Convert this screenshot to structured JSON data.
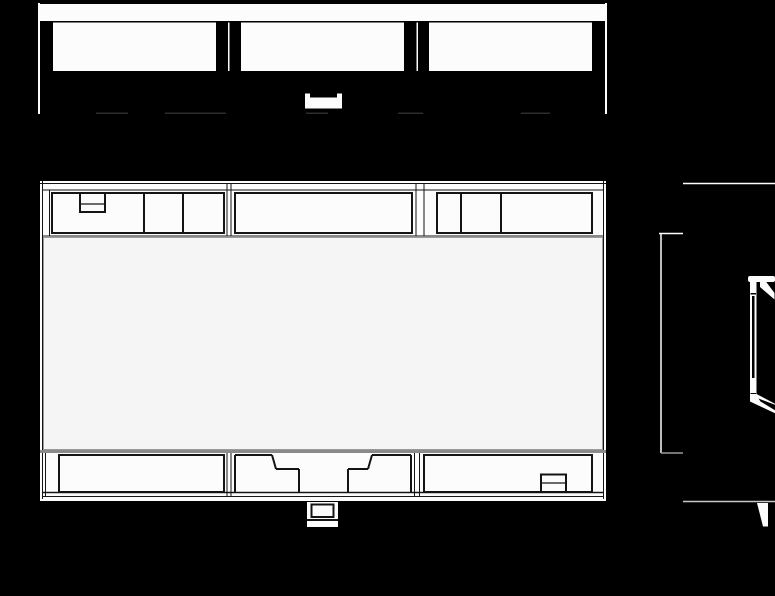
{
  "canvas": {
    "width": 775,
    "height": 596,
    "background": "#000000"
  },
  "palette": {
    "white": "#fcfcfc",
    "ink": "#141414",
    "face": "#f5f5f5",
    "gray": "#8a8a8a",
    "light": "#c8c8c8",
    "faint": "#3c3c3c",
    "black": "#000000"
  },
  "drawing_title": "din-rail-module-orthographic-views",
  "views": [
    {
      "id": "top-view",
      "shapes": [
        {
          "name": "outline-left",
          "type": "rect",
          "x": 38,
          "y": 3,
          "w": 2,
          "h": 111,
          "fill": "white"
        },
        {
          "name": "outline-right",
          "type": "rect",
          "x": 605,
          "y": 3,
          "w": 2,
          "h": 111,
          "fill": "white"
        },
        {
          "name": "front-rim",
          "type": "rect",
          "x": 40,
          "y": 4,
          "w": 566,
          "h": 17,
          "fill": "white"
        },
        {
          "name": "terminal-window-1",
          "type": "rect",
          "x": 53,
          "y": 22.5,
          "w": 163,
          "h": 48.5,
          "fill": "white"
        },
        {
          "name": "terminal-window-2",
          "type": "rect",
          "x": 241,
          "y": 22.5,
          "w": 163,
          "h": 48.5,
          "fill": "white"
        },
        {
          "name": "terminal-window-3",
          "type": "rect",
          "x": 429,
          "y": 22.5,
          "w": 163,
          "h": 48.5,
          "fill": "white"
        },
        {
          "name": "module-joint-line-1",
          "type": "rect",
          "x": 228,
          "y": 22.5,
          "w": 1.5,
          "h": 48.5,
          "fill": "white"
        },
        {
          "name": "module-joint-line-2",
          "type": "rect",
          "x": 416.5,
          "y": 22.5,
          "w": 1.5,
          "h": 48.5,
          "fill": "white"
        },
        {
          "name": "bus-connector",
          "type": "rect",
          "x": 305,
          "y": 97.5,
          "w": 37,
          "h": 11,
          "fill": "white"
        },
        {
          "name": "bus-connector-ear-left",
          "type": "rect",
          "x": 305,
          "y": 93.5,
          "w": 5,
          "h": 5,
          "fill": "white"
        },
        {
          "name": "bus-connector-ear-right",
          "type": "rect",
          "x": 337,
          "y": 93.5,
          "w": 5,
          "h": 5,
          "fill": "white"
        },
        {
          "name": "hidden-edge-dash-1",
          "type": "line",
          "x1": 96,
          "y1": 113.2,
          "x2": 128,
          "y2": 113.2,
          "stroke": "faint",
          "sw": 1.2
        },
        {
          "name": "hidden-edge-dash-2",
          "type": "line",
          "x1": 165,
          "y1": 113.2,
          "x2": 226,
          "y2": 113.2,
          "stroke": "faint",
          "sw": 1.2
        },
        {
          "name": "hidden-edge-dash-3",
          "type": "line",
          "x1": 306,
          "y1": 113.2,
          "x2": 328,
          "y2": 113.2,
          "stroke": "faint",
          "sw": 1.2
        },
        {
          "name": "hidden-edge-dash-4",
          "type": "line",
          "x1": 398,
          "y1": 113.2,
          "x2": 423,
          "y2": 113.2,
          "stroke": "faint",
          "sw": 1.2
        },
        {
          "name": "hidden-edge-dash-5",
          "type": "line",
          "x1": 521,
          "y1": 113.2,
          "x2": 550,
          "y2": 113.2,
          "stroke": "faint",
          "sw": 1.2
        }
      ]
    },
    {
      "id": "front-view",
      "shapes": [
        {
          "name": "body",
          "type": "rect",
          "x": 40,
          "y": 181,
          "w": 566,
          "h": 320,
          "fill": "white"
        },
        {
          "name": "edge-top",
          "type": "line",
          "x1": 40,
          "y1": 183.5,
          "x2": 606,
          "y2": 183.5,
          "stroke": "ink",
          "sw": 1
        },
        {
          "name": "edge-left",
          "type": "line",
          "x1": 42.5,
          "y1": 181,
          "x2": 42.5,
          "y2": 499,
          "stroke": "ink",
          "sw": 1
        },
        {
          "name": "edge-right",
          "type": "line",
          "x1": 603.5,
          "y1": 181,
          "x2": 603.5,
          "y2": 499,
          "stroke": "ink",
          "sw": 1
        },
        {
          "name": "ledge-top",
          "type": "line",
          "x1": 43,
          "y1": 190,
          "x2": 603,
          "y2": 190,
          "stroke": "ink",
          "sw": 1
        },
        {
          "name": "edge-bottom",
          "type": "line",
          "x1": 43,
          "y1": 496.5,
          "x2": 603,
          "y2": 496.5,
          "stroke": "ink",
          "sw": 1
        },
        {
          "name": "margin-line-top-left",
          "type": "line",
          "x1": 49.5,
          "y1": 190,
          "x2": 49.5,
          "y2": 236,
          "stroke": "ink",
          "sw": 1
        },
        {
          "name": "margin-line-bottom-left",
          "type": "line",
          "x1": 45.5,
          "y1": 453,
          "x2": 45.5,
          "y2": 496,
          "stroke": "ink",
          "sw": 1
        },
        {
          "name": "top-terminal-block-1",
          "type": "rect",
          "x": 52,
          "y": 193,
          "w": 172,
          "h": 40,
          "stroke": "ink",
          "sw": 2
        },
        {
          "name": "top-terminal-block-2",
          "type": "rect",
          "x": 235,
          "y": 193,
          "w": 177,
          "h": 40,
          "stroke": "ink",
          "sw": 2
        },
        {
          "name": "top-terminal-block-3",
          "type": "rect",
          "x": 437,
          "y": 193,
          "w": 155,
          "h": 40,
          "stroke": "ink",
          "sw": 2
        },
        {
          "name": "top-divider-1",
          "type": "line",
          "x1": 144,
          "y1": 193,
          "x2": 144,
          "y2": 233,
          "stroke": "ink",
          "sw": 2
        },
        {
          "name": "top-divider-2",
          "type": "line",
          "x1": 183,
          "y1": 193,
          "x2": 183,
          "y2": 233,
          "stroke": "ink",
          "sw": 2
        },
        {
          "name": "top-divider-3",
          "type": "line",
          "x1": 461,
          "y1": 193,
          "x2": 461,
          "y2": 233,
          "stroke": "ink",
          "sw": 2
        },
        {
          "name": "top-divider-4",
          "type": "line",
          "x1": 501,
          "y1": 193,
          "x2": 501,
          "y2": 233,
          "stroke": "ink",
          "sw": 2
        },
        {
          "name": "top-terminal-notch",
          "type": "rect",
          "x": 80,
          "y": 193,
          "w": 25,
          "h": 19,
          "stroke": "ink",
          "sw": 2
        },
        {
          "name": "top-terminal-notch-line",
          "type": "line",
          "x1": 80,
          "y1": 204,
          "x2": 105,
          "y2": 204,
          "stroke": "ink",
          "sw": 1.2
        },
        {
          "name": "joint-top-left-a",
          "type": "line",
          "x1": 227,
          "y1": 184,
          "x2": 227,
          "y2": 236,
          "stroke": "ink",
          "sw": 1
        },
        {
          "name": "joint-top-left-b",
          "type": "line",
          "x1": 231,
          "y1": 184,
          "x2": 231,
          "y2": 236,
          "stroke": "ink",
          "sw": 1
        },
        {
          "name": "joint-top-right-a",
          "type": "line",
          "x1": 416,
          "y1": 184,
          "x2": 416,
          "y2": 236,
          "stroke": "ink",
          "sw": 1
        },
        {
          "name": "joint-top-right-b",
          "type": "line",
          "x1": 424,
          "y1": 184,
          "x2": 424,
          "y2": 236,
          "stroke": "ink",
          "sw": 1
        },
        {
          "name": "joint-bottom-left-a",
          "type": "line",
          "x1": 227,
          "y1": 451,
          "x2": 227,
          "y2": 496,
          "stroke": "ink",
          "sw": 1
        },
        {
          "name": "joint-bottom-left-b",
          "type": "line",
          "x1": 231,
          "y1": 451,
          "x2": 231,
          "y2": 496,
          "stroke": "ink",
          "sw": 1
        },
        {
          "name": "joint-bottom-right-a",
          "type": "line",
          "x1": 414.5,
          "y1": 451,
          "x2": 414.5,
          "y2": 496,
          "stroke": "ink",
          "sw": 1
        },
        {
          "name": "joint-bottom-right-b",
          "type": "line",
          "x1": 419.5,
          "y1": 451,
          "x2": 419.5,
          "y2": 496,
          "stroke": "ink",
          "sw": 1
        },
        {
          "name": "front-plate",
          "type": "rect",
          "x": 43.5,
          "y": 237.5,
          "w": 559,
          "h": 212,
          "fill": "face",
          "stroke": "#9a9a9a",
          "sw": 1
        },
        {
          "name": "front-plate-top-line",
          "type": "line",
          "x1": 43,
          "y1": 236,
          "x2": 603,
          "y2": 236,
          "stroke": "ink",
          "sw": 1
        },
        {
          "name": "din-rail-shadow-bar",
          "type": "rect",
          "x": 40,
          "y": 450,
          "w": 566,
          "h": 3,
          "fill": "gray"
        },
        {
          "name": "bottom-terminal-block-1",
          "type": "rect",
          "x": 59,
          "y": 455,
          "w": 165,
          "h": 37,
          "stroke": "ink",
          "sw": 2
        },
        {
          "name": "bottom-terminal-block-3",
          "type": "rect",
          "x": 424,
          "y": 455,
          "w": 168,
          "h": 37,
          "stroke": "ink",
          "sw": 2
        },
        {
          "name": "block2-top-left",
          "type": "line",
          "x1": 235,
          "y1": 455,
          "x2": 272,
          "y2": 455,
          "stroke": "ink",
          "sw": 2
        },
        {
          "name": "block2-top-right",
          "type": "line",
          "x1": 372,
          "y1": 455,
          "x2": 411,
          "y2": 455,
          "stroke": "ink",
          "sw": 2
        },
        {
          "name": "block2-left",
          "type": "line",
          "x1": 235,
          "y1": 455,
          "x2": 235,
          "y2": 492,
          "stroke": "ink",
          "sw": 2
        },
        {
          "name": "block2-right",
          "type": "line",
          "x1": 411,
          "y1": 455,
          "x2": 411,
          "y2": 492,
          "stroke": "ink",
          "sw": 2
        },
        {
          "name": "clip-cutout-diag-left",
          "type": "line",
          "x1": 272,
          "y1": 455,
          "x2": 276,
          "y2": 469,
          "stroke": "ink",
          "sw": 2
        },
        {
          "name": "clip-cutout-diag-right",
          "type": "line",
          "x1": 372,
          "y1": 455,
          "x2": 368,
          "y2": 469,
          "stroke": "ink",
          "sw": 2
        },
        {
          "name": "clip-cutout-shelf-left",
          "type": "line",
          "x1": 276,
          "y1": 469,
          "x2": 299,
          "y2": 469,
          "stroke": "ink",
          "sw": 2
        },
        {
          "name": "clip-cutout-shelf-right",
          "type": "line",
          "x1": 348,
          "y1": 469,
          "x2": 368,
          "y2": 469,
          "stroke": "ink",
          "sw": 2
        },
        {
          "name": "clip-cutout-side-left",
          "type": "line",
          "x1": 299,
          "y1": 469,
          "x2": 299,
          "y2": 492,
          "stroke": "ink",
          "sw": 2
        },
        {
          "name": "clip-cutout-side-right",
          "type": "line",
          "x1": 348,
          "y1": 469,
          "x2": 348,
          "y2": 492,
          "stroke": "ink",
          "sw": 2
        },
        {
          "name": "bottom-edge-line",
          "type": "line",
          "x1": 43,
          "y1": 492.5,
          "x2": 603,
          "y2": 492.5,
          "stroke": "ink",
          "sw": 1.5
        },
        {
          "name": "bottom-terminal-box",
          "type": "rect",
          "x": 541,
          "y": 474.5,
          "w": 25,
          "h": 17.5,
          "stroke": "ink",
          "sw": 2
        },
        {
          "name": "bottom-terminal-box-line",
          "type": "line",
          "x1": 541,
          "y1": 483,
          "x2": 566,
          "y2": 483,
          "stroke": "ink",
          "sw": 1.2
        },
        {
          "name": "rail-clip-tab",
          "type": "rect",
          "x": 307,
          "y": 502,
          "w": 31,
          "h": 25,
          "fill": "white"
        },
        {
          "name": "rail-clip-tab-inner",
          "type": "rect",
          "x": 311.5,
          "y": 504.5,
          "w": 22,
          "h": 12.5,
          "stroke": "ink",
          "sw": 2
        },
        {
          "name": "rail-clip-tab-line",
          "type": "line",
          "x1": 307,
          "y1": 520,
          "x2": 338,
          "y2": 520,
          "stroke": "ink",
          "sw": 2
        }
      ]
    },
    {
      "id": "side-view",
      "shapes": [
        {
          "name": "top-edge",
          "type": "line",
          "x1": 683,
          "y1": 183.5,
          "x2": 775,
          "y2": 183.5,
          "stroke": "white",
          "sw": 1.5
        },
        {
          "name": "top-step",
          "type": "line",
          "x1": 659,
          "y1": 233.5,
          "x2": 683,
          "y2": 233.5,
          "stroke": "white",
          "sw": 1.5
        },
        {
          "name": "front-face-edge",
          "type": "line",
          "x1": 661,
          "y1": 233.5,
          "x2": 661,
          "y2": 453,
          "stroke": "white",
          "sw": 1.5
        },
        {
          "name": "bottom-step",
          "type": "line",
          "x1": 661,
          "y1": 453,
          "x2": 683,
          "y2": 453,
          "stroke": "#9a9a9a",
          "sw": 1.5
        },
        {
          "name": "bottom-edge",
          "type": "line",
          "x1": 683,
          "y1": 501.5,
          "x2": 775,
          "y2": 501.5,
          "stroke": "light",
          "sw": 1.5
        },
        {
          "name": "rail-clip-hook",
          "type": "polygon",
          "points": [
            [
              757,
              503
            ],
            [
              768,
              503
            ],
            [
              768,
              526.5
            ],
            [
              763,
              526.5
            ]
          ],
          "fill": "white"
        },
        {
          "name": "din-rail-top-flange",
          "type": "rect",
          "x": 748,
          "y": 276,
          "w": 27,
          "h": 6,
          "rx": 2,
          "fill": "white"
        },
        {
          "name": "din-rail-top-lip",
          "type": "polygon",
          "points": [
            [
              760,
              281
            ],
            [
              765.5,
              281
            ],
            [
              774.5,
              293
            ],
            [
              774.5,
              299.5
            ],
            [
              760,
              287
            ]
          ],
          "fill": "white"
        },
        {
          "name": "din-rail-web",
          "type": "rect",
          "x": 750,
          "y": 282,
          "w": 6.5,
          "h": 114,
          "fill": "white"
        },
        {
          "name": "din-rail-web-core",
          "type": "rect",
          "x": 752,
          "y": 296,
          "w": 2.5,
          "h": 82,
          "fill": "black"
        },
        {
          "name": "din-rail-web-tick-top",
          "type": "rect",
          "x": 750.5,
          "y": 293,
          "w": 5.5,
          "h": 1.5,
          "fill": "black"
        },
        {
          "name": "din-rail-web-tick-bottom",
          "type": "rect",
          "x": 750.5,
          "y": 393,
          "w": 5.5,
          "h": 1.5,
          "fill": "black"
        },
        {
          "name": "din-rail-bottom-flange",
          "type": "polygon",
          "points": [
            [
              750,
              394
            ],
            [
              756.5,
              394
            ],
            [
              775.5,
              404
            ],
            [
              775.5,
              413.5
            ],
            [
              750,
              401.5
            ]
          ],
          "fill": "white"
        },
        {
          "name": "din-rail-bottom-notch",
          "type": "polygon",
          "points": [
            [
              758.5,
              398.5
            ],
            [
              775.5,
              405
            ],
            [
              775.5,
              410.5
            ],
            [
              760.5,
              401.5
            ]
          ],
          "fill": "black"
        }
      ]
    }
  ]
}
